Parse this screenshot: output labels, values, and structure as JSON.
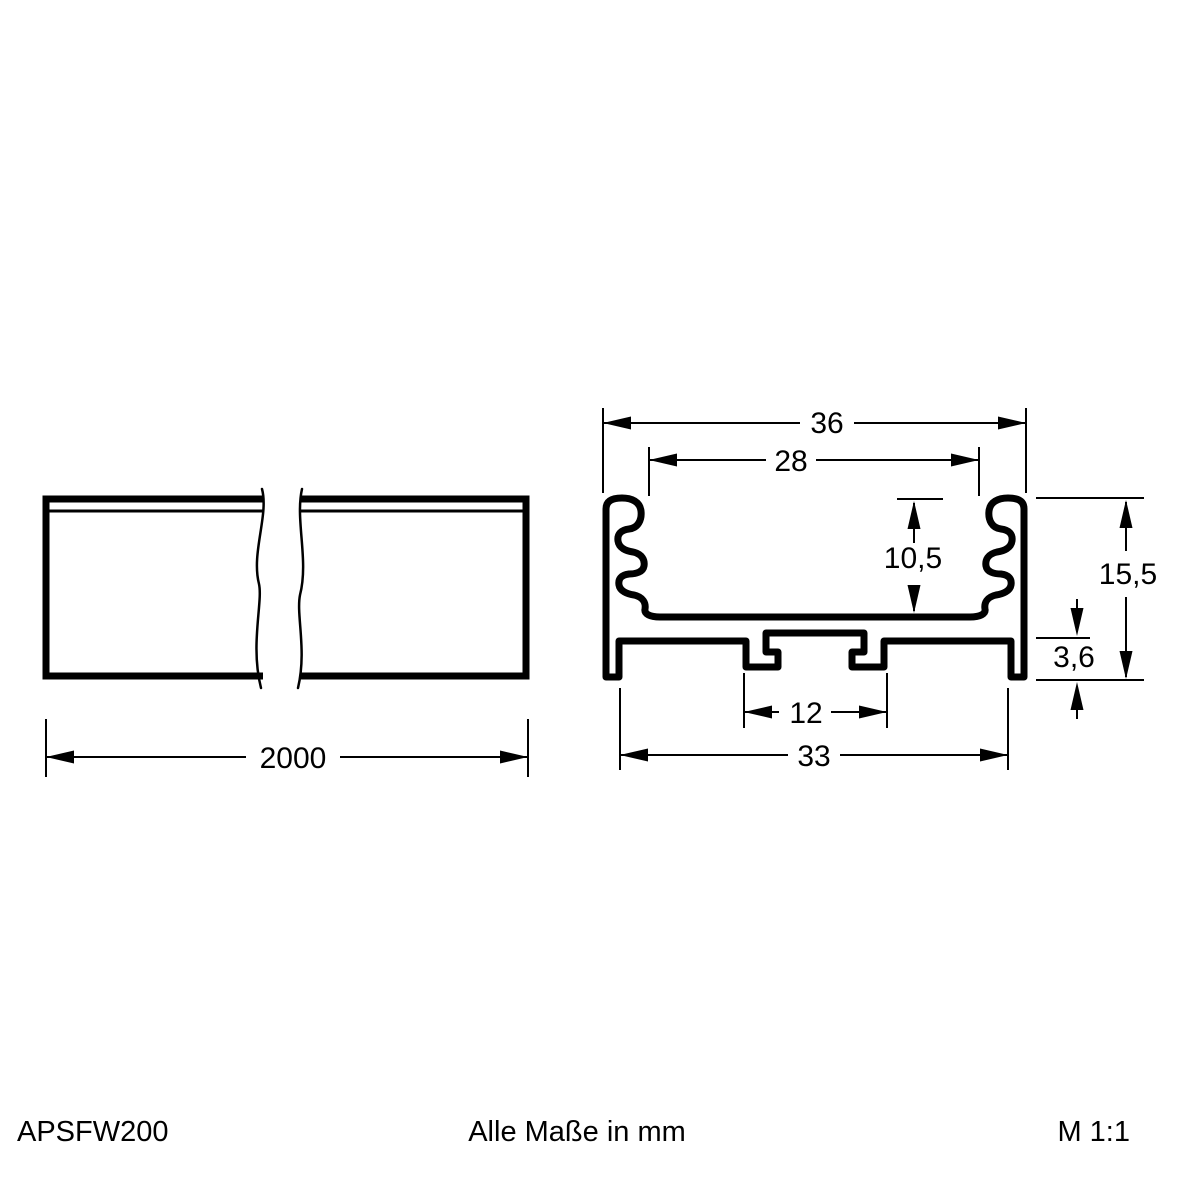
{
  "footer": {
    "product_code": "APSFW200",
    "units_note": "Alle Maße in mm",
    "scale": "M 1:1"
  },
  "side_view": {
    "length": "2000"
  },
  "cross_section": {
    "outer_width": "36",
    "inner_width": "28",
    "inner_depth": "10,5",
    "total_height": "15,5",
    "base_height": "3,6",
    "slot_width": "12",
    "bottom_width": "33"
  },
  "colors": {
    "line": "#000000",
    "background": "#ffffff"
  }
}
